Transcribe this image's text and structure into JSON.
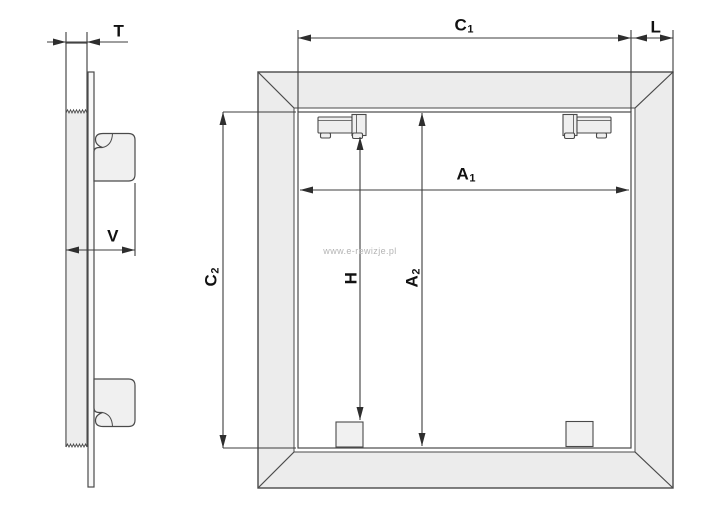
{
  "watermark": {
    "text": "www.e-rewizje.pl"
  },
  "colors": {
    "line": "#4a4a4a",
    "dimension_line": "#3d3d3d",
    "frame_fill": "#ececec",
    "wall_fill": "#ededed",
    "hardware_fill": "#efefef",
    "label_text": "#111111",
    "watermark_text": "#b4b4b4",
    "background": "#ffffff"
  },
  "side_view": {
    "dimensions": {
      "t": {
        "base": "T",
        "sub": ""
      },
      "v": {
        "base": "V",
        "sub": ""
      }
    }
  },
  "front_view": {
    "dimensions": {
      "c1": {
        "base": "C",
        "sub": "1"
      },
      "l": {
        "base": "L",
        "sub": ""
      },
      "a1": {
        "base": "A",
        "sub": "1"
      },
      "c2": {
        "base": "C",
        "sub": "2"
      },
      "h": {
        "base": "H",
        "sub": ""
      },
      "a2": {
        "base": "A",
        "sub": "2"
      }
    }
  }
}
